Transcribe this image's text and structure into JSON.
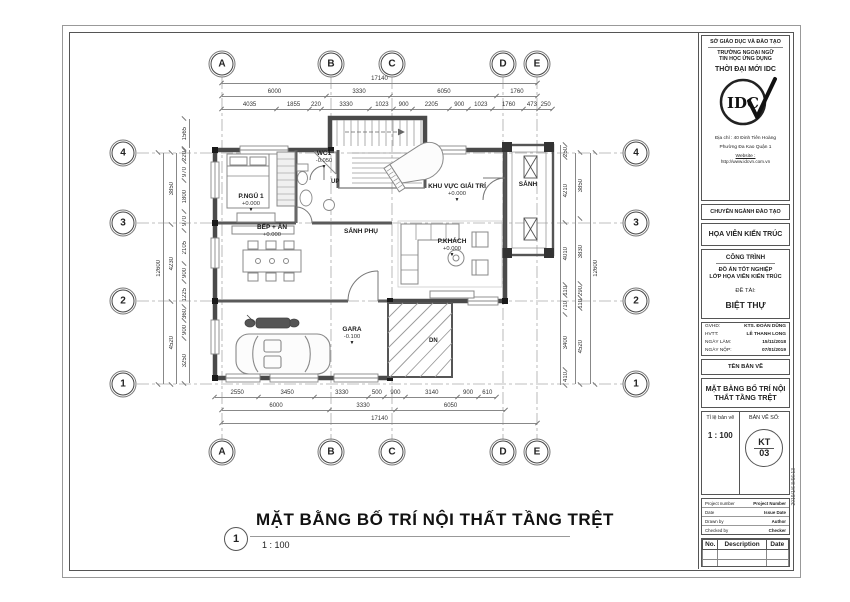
{
  "sheet": {
    "drawing_title": {
      "number": "1",
      "text": "MẶT BẰNG BỐ TRÍ NỘI THẤT TẦNG TRỆT",
      "scale": "1 : 100"
    },
    "timestamp": "2019/1/6 8:56:13"
  },
  "titleblock": {
    "org1": "SỞ GIÁO DỤC VÀ ĐÀO TẠO",
    "org2": "TRƯỜNG NGOẠI NGỮ",
    "org3": "TIN HỌC ỨNG DỤNG",
    "org4": "THỜI ĐẠI MỚI IDC",
    "logo_text": "IDC",
    "address1": "Địa chỉ : 40 Đinh Tiên Hoàng",
    "address2": "Phường Đa Kao Quận 1",
    "website_label": "Website :",
    "website_url": "http://www.idcvn.com.vn",
    "dept_label": "CHUYÊN NGÀNH ĐÀO TẠO",
    "dept_value": "HỌA VIÊN KIẾN TRÚC",
    "project_label": "CÔNG TRÌNH",
    "project_line1": "ĐỒ ÁN TỐT NGHIỆP",
    "project_line2": "LỚP HỌA VIÊN KIẾN TRÚC",
    "topic_label": "ĐỀ TÀI:",
    "topic_value": "BIỆT THỰ",
    "info_rows": [
      {
        "label": "GVHD:",
        "value": "KTS. ĐOÀN DŨNG"
      },
      {
        "label": "HVTT:",
        "value": "LÊ THANH LONG"
      },
      {
        "label": "NGÀY LÀM:",
        "value": "15/11/2018"
      },
      {
        "label": "NGÀY NỘP:",
        "value": "07/01/2019"
      }
    ],
    "sheetname_label": "TÊN BẢN VẼ",
    "sheetname_value1": "MẶT BẰNG BỐ TRÍ NỘI",
    "sheetname_value2": "THẤT TẦNG TRỆT",
    "scale_label": "Tỉ lệ bản vẽ",
    "scale_value": "1 : 100",
    "sheetno_label": "BẢN VẼ SỐ:",
    "sheetno_value1": "KT",
    "sheetno_value2": "03",
    "meta_rows": [
      {
        "label": "Project number",
        "value": "Project Number"
      },
      {
        "label": "Date",
        "value": "Issue Date"
      },
      {
        "label": "Drawn by",
        "value": "Author"
      },
      {
        "label": "Checked by",
        "value": "Checker"
      }
    ],
    "rev_headers": [
      "No.",
      "Description",
      "Date"
    ]
  },
  "plan": {
    "grid_cols": [
      "A",
      "B",
      "C",
      "D",
      "E"
    ],
    "grid_rows": [
      "4",
      "3",
      "2",
      "1"
    ],
    "dims": {
      "top_total": [
        "17140"
      ],
      "top_mid": [
        "6000",
        "3330",
        "6050",
        "1760"
      ],
      "top_detail": [
        "4035",
        "1855",
        "220",
        "3330",
        "1023",
        "900",
        "2205",
        "900",
        "1023",
        "1760",
        "473",
        "250"
      ],
      "bottom_detail": [
        "2550",
        "3450",
        "3330",
        "500",
        "900",
        "3140",
        "900",
        "610"
      ],
      "bottom_mid": [
        "6000",
        "3330",
        "6050"
      ],
      "bottom_total": [
        "17140"
      ],
      "left_total": [
        "12600"
      ],
      "left_mid": [
        "3850",
        "4230",
        "4520"
      ],
      "left_detail": [
        "220",
        "970",
        "1800",
        "970",
        "2105",
        "900",
        "1225",
        "360",
        "900",
        "3250"
      ],
      "left_top": [
        "1565"
      ],
      "right_detail": [
        "250",
        "4210",
        "4010",
        "110",
        "710",
        "3400",
        "410"
      ],
      "right_mid": [
        "3850",
        "3830",
        "290",
        "110",
        "4520"
      ],
      "right_total": [
        "12600"
      ]
    },
    "rooms": {
      "bedroom": {
        "name": "P.NGỦ 1",
        "level": "+0.000"
      },
      "wc": {
        "name": "WC1",
        "level": "-0.050"
      },
      "entertainment": {
        "name": "KHU VỰC GIẢI TRÍ",
        "level": "+0.000"
      },
      "porch": {
        "name": "SẢNH"
      },
      "hall": {
        "name": "SẢNH PHỤ"
      },
      "kitchen": {
        "name": "BẾP + ĂN",
        "level": "+0.000"
      },
      "living": {
        "name": "P.KHÁCH",
        "level": "+0.000"
      },
      "garage": {
        "name": "GARA",
        "level": "-0.100"
      }
    },
    "labels": {
      "up": "UP",
      "down": "DN",
      "level_mark": "▼"
    }
  }
}
